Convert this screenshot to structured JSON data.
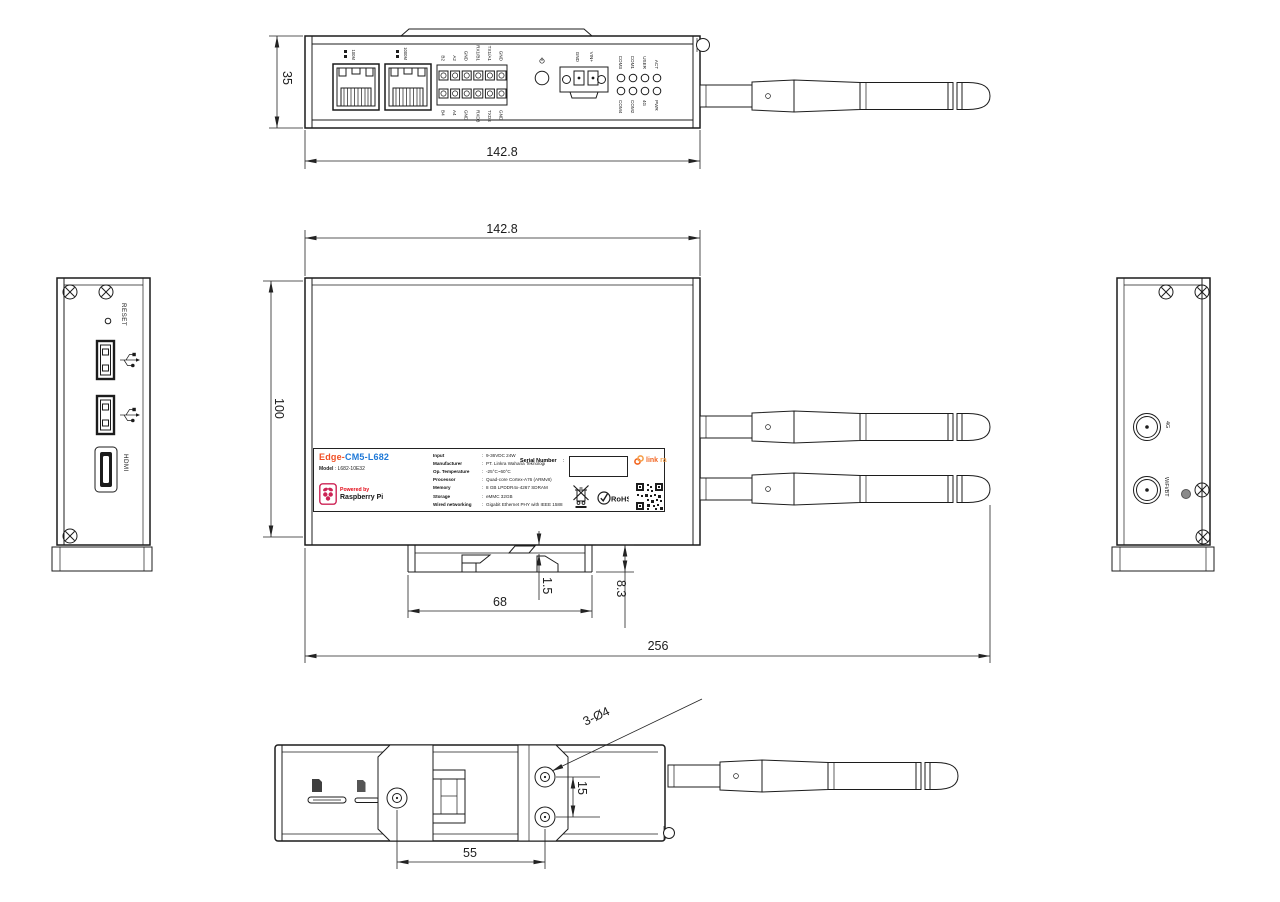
{
  "top_view": {
    "dim_height": "35",
    "dim_width": "142.8",
    "eth_labels": [
      "100M",
      "1000M"
    ],
    "terminal_top": [
      "B2",
      "A2",
      "GND",
      "RX1/B1",
      "TX1/A1",
      "GND"
    ],
    "terminal_bottom": [
      "B4",
      "A4",
      "GND",
      "RXD3",
      "TXD3",
      "GND"
    ],
    "power_pins": [
      "GND",
      "VIN+"
    ],
    "led_top": [
      "COM3",
      "COM1",
      "USER",
      "ACT"
    ],
    "led_bottom": [
      "COM4",
      "COM2",
      "4G",
      "PWR"
    ],
    "power_icon": "power-symbol"
  },
  "front_view": {
    "dim_width": "142.8",
    "dim_height": "100",
    "dim_overall": "256",
    "dim_bracket": "68",
    "dim_lip": "1.5",
    "dim_rail": "8.3"
  },
  "left_view": {
    "reset_label": "RESET",
    "hdmi_label": "HDMI",
    "usb_icon": "usb-trident"
  },
  "right_view": {
    "ant_4g": "4G",
    "ant_wifi": "WiFi/BT"
  },
  "bottom_view": {
    "dim_holes_x": "55",
    "dim_holes_y": "15",
    "hole_callout": "3-Ø4"
  },
  "label": {
    "title_prefix": "Edge-",
    "title_main": "CM5-L682",
    "model_key": "Model",
    "model_sep": ":",
    "model_value": "L682-10E32",
    "powered_by": "Powered by",
    "raspberry": "Raspberry Pi",
    "spec_sep": ":",
    "specs": [
      {
        "key": "Input",
        "value": "9-36VDC 24W"
      },
      {
        "key": "Manufacturer",
        "value": "PT. Linkra Wahana Teknologi"
      },
      {
        "key": "Op. Temperature",
        "value": "-25°C~60°C"
      },
      {
        "key": "Processor",
        "value": "Quad-core Cortex-A76 (ARMv8)"
      },
      {
        "key": "Memory",
        "value": "8 GB LPDDR4x-4267 SDRAM"
      },
      {
        "key": "Storage",
        "value": "eMMC 32GB"
      },
      {
        "key": "Wired networking",
        "value": "Gigabit Ethernet PHY with IEEE 1588"
      }
    ],
    "serial_label": "Serial Number",
    "serial_sep": ":",
    "rohs": "RoHS",
    "brand_link": "link",
    "brand_ra": "ra"
  },
  "colors": {
    "line": "#1c1c1c",
    "title_orange": "#f04e23",
    "title_blue": "#1e78d7",
    "raspberry_pink": "#cd2355",
    "powered_red": "#e30613",
    "linkra_orange": "#f26522"
  }
}
